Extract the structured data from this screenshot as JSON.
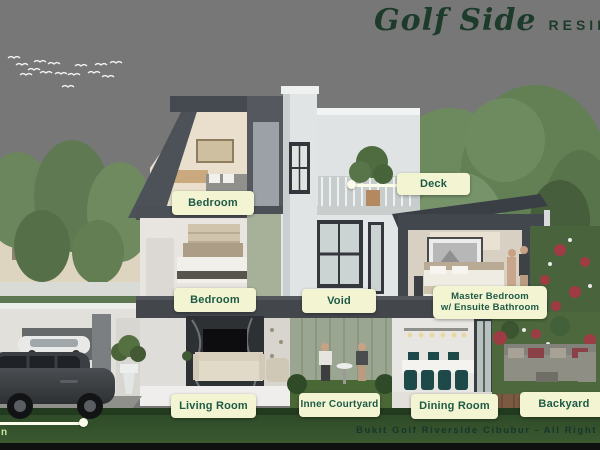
{
  "brand": {
    "script": "Golf Side",
    "caps": "RESIDENC"
  },
  "annotations": {
    "deck": "Deck",
    "bedroom_top": "Bedroom",
    "bedroom_mid": "Bedroom",
    "void": "Void",
    "master_line1": "Master Bedroom",
    "master_line2": "w/ Ensuite Bathroom",
    "living_room": "Living Room",
    "inner_courtyard": "Inner Courtyard",
    "dining_room": "Dining Room",
    "backyard": "Backyard",
    "partial_left": "n"
  },
  "footer": {
    "credit": "Bukit Golf Riverside Cibubur - All Right Reserve"
  },
  "palette": {
    "label_bg": "#f2f4d2",
    "label_text": "#1e5a45",
    "brand_green": "#1d3b2a",
    "sky_top": "#c2d4e2",
    "grass": "#3a5a31",
    "house_dark": "#43474c",
    "sage_panel": "#a7b199"
  }
}
